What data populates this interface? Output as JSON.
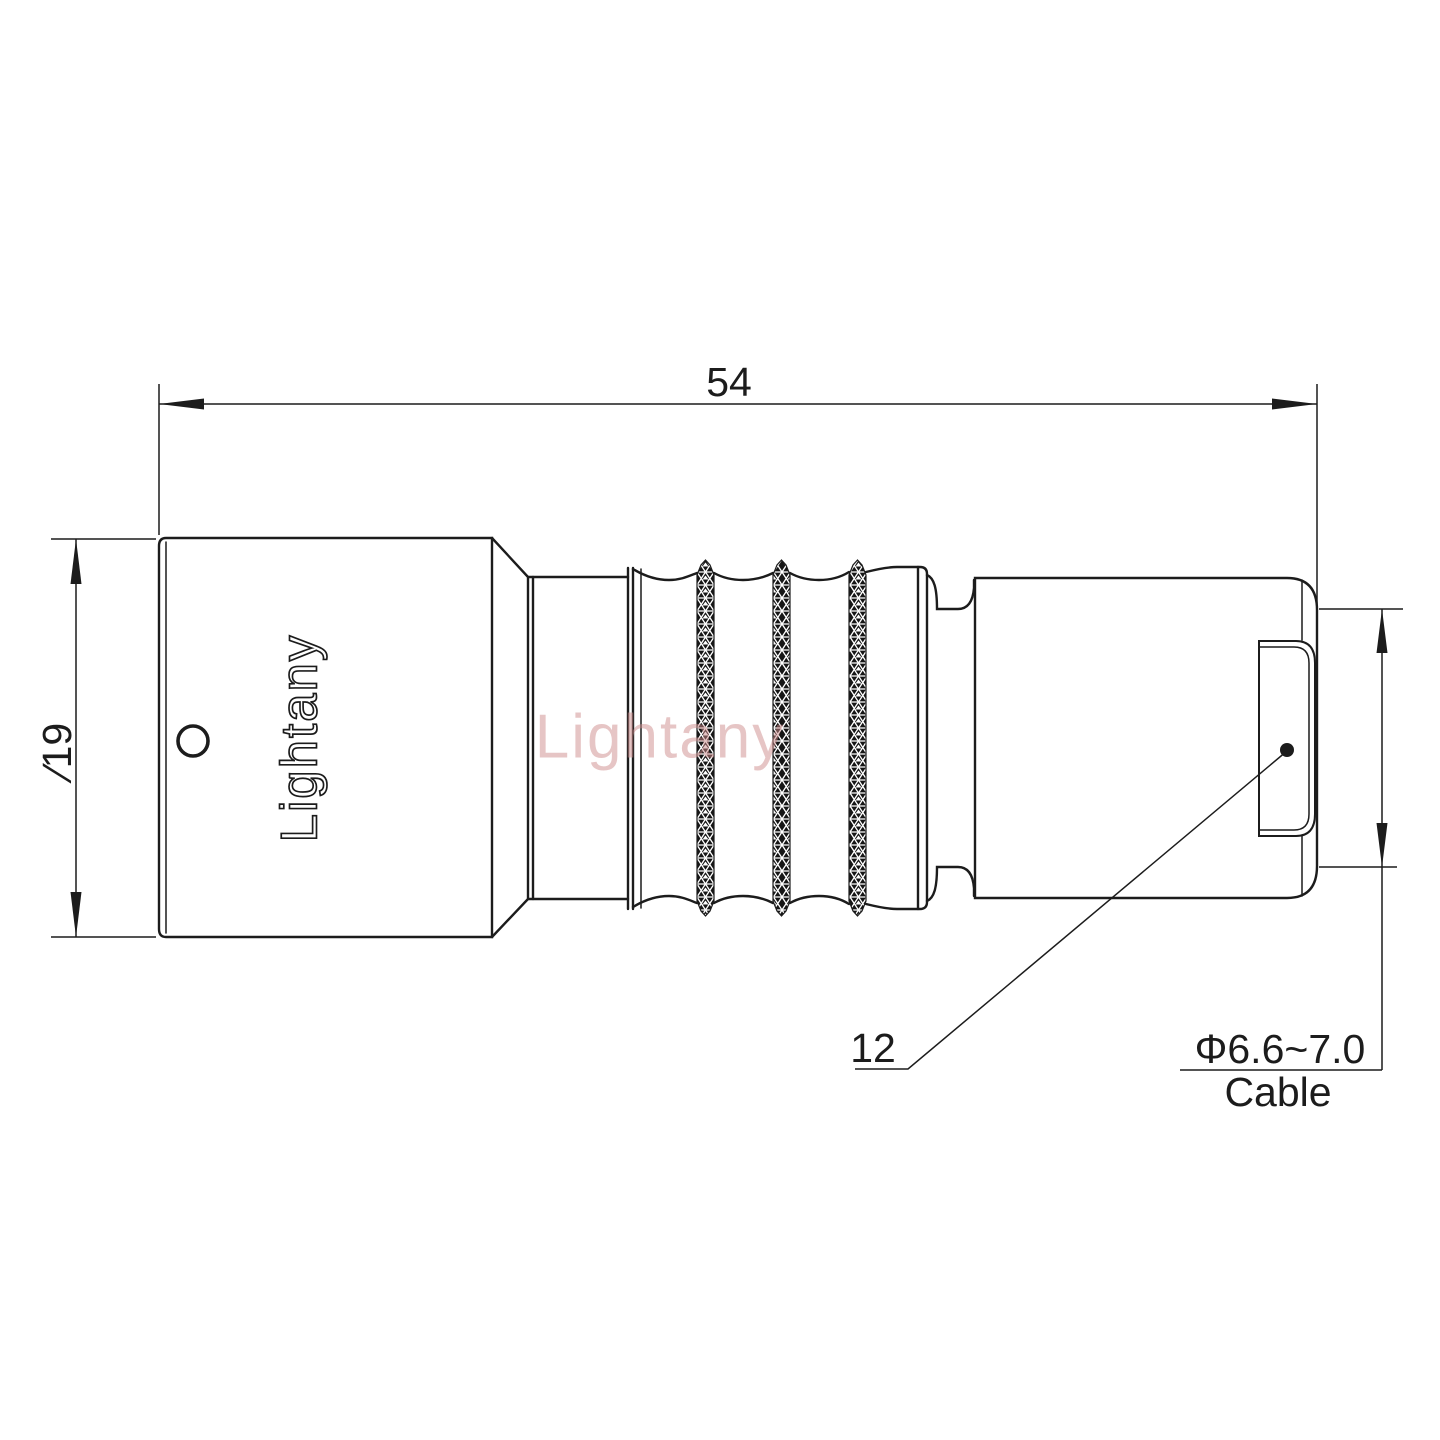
{
  "drawing": {
    "dims": {
      "overall_length": "54",
      "front_diameter": "∕19",
      "rear_ref": "12",
      "cable_range": "Φ6.6~7.0",
      "cable_label": "Cable"
    },
    "engraving": "Lightany",
    "watermark": "Lightany",
    "colors": {
      "line": "#1c1c1c",
      "watermark": "#cf8d8d",
      "background": "#ffffff"
    }
  }
}
